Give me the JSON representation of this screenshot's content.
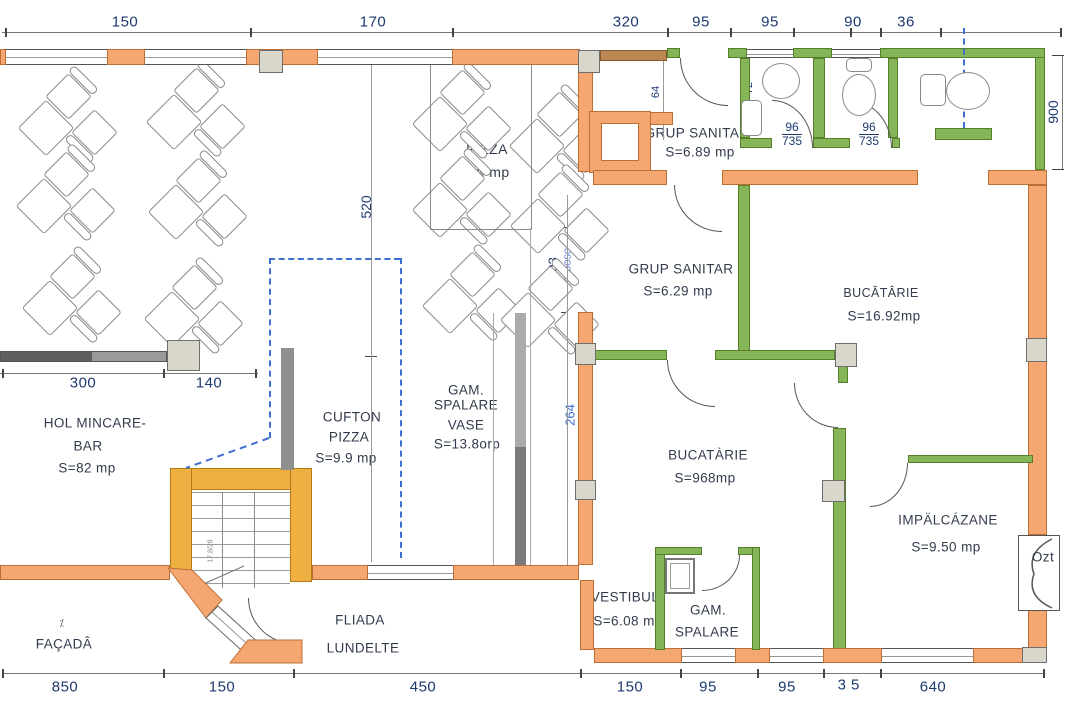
{
  "dims": {
    "top": [
      "150",
      "170",
      "320",
      "95",
      "95",
      "90",
      "36"
    ],
    "left": [
      "300",
      "140"
    ],
    "bottom": [
      "850",
      "150",
      "450",
      "150",
      "95",
      "95",
      "35",
      "640"
    ],
    "right": "900",
    "inner": {
      "hol_vertical": "520",
      "mid_upper": "203",
      "mid_note": "PEDOSO",
      "mid_lower": "264",
      "door_width": "64",
      "sink_width": "72",
      "stall_a_num": "96",
      "stall_a_den": "735",
      "stall_b_num": "96",
      "stall_b_den": "735",
      "stair_note": "17,8/28"
    }
  },
  "rooms": {
    "hol_pizza": {
      "line1": "HOL",
      "line2": "PIZZA",
      "area": "S=9 mp"
    },
    "grup_sanitar_top": {
      "line1": "GRUP SANITAR",
      "area": "S=6.89 mp"
    },
    "grup_sanitar_mid": {
      "line1": "GRUP SANITAR",
      "area": "S=6.29 mp"
    },
    "bucatarie_top": {
      "line1": "BUCĂTÂRIE",
      "area": "S=16.92mp"
    },
    "hol_mincare": {
      "line1": "HOL MINCARE-",
      "line2": "BAR",
      "area": "S=82 mp"
    },
    "cufton_pizza": {
      "line1": "CUFTON",
      "line2": "PIZZA",
      "area": "S=9.9 mp"
    },
    "gam_spalare_vase": {
      "line1": "GAM.",
      "line2": "SPALARE",
      "line3": "VASE",
      "area": "S=13.8orp"
    },
    "bucatarie_main": {
      "line1": "BUCATÀRIE",
      "area": "S=968mp"
    },
    "impalcazane": {
      "line1": "IMPÄLCÁZANE",
      "area": "S=9.50 mp"
    },
    "vestibul": {
      "line1": "VESTIBUL",
      "area": "S=6.08 mp"
    },
    "gam_spalare": {
      "line1": "GAM.",
      "line2": "SPALARE"
    },
    "terrace": {
      "line1": "FLIADA",
      "line2": "LUNDELTE"
    },
    "facade": {
      "label": "FAÇADÂ",
      "mark": "⁒"
    },
    "door_right": {
      "label": "Ozt"
    }
  },
  "colors": {
    "wall_orange": "#f4a770",
    "wall_green": "#85b556",
    "wall_yellow": "#efb041",
    "wall_brown": "#bb8755",
    "dashed_blue": "#3f6fd0",
    "dim_text": "#1c3a6e",
    "room_text": "#323b4d"
  }
}
